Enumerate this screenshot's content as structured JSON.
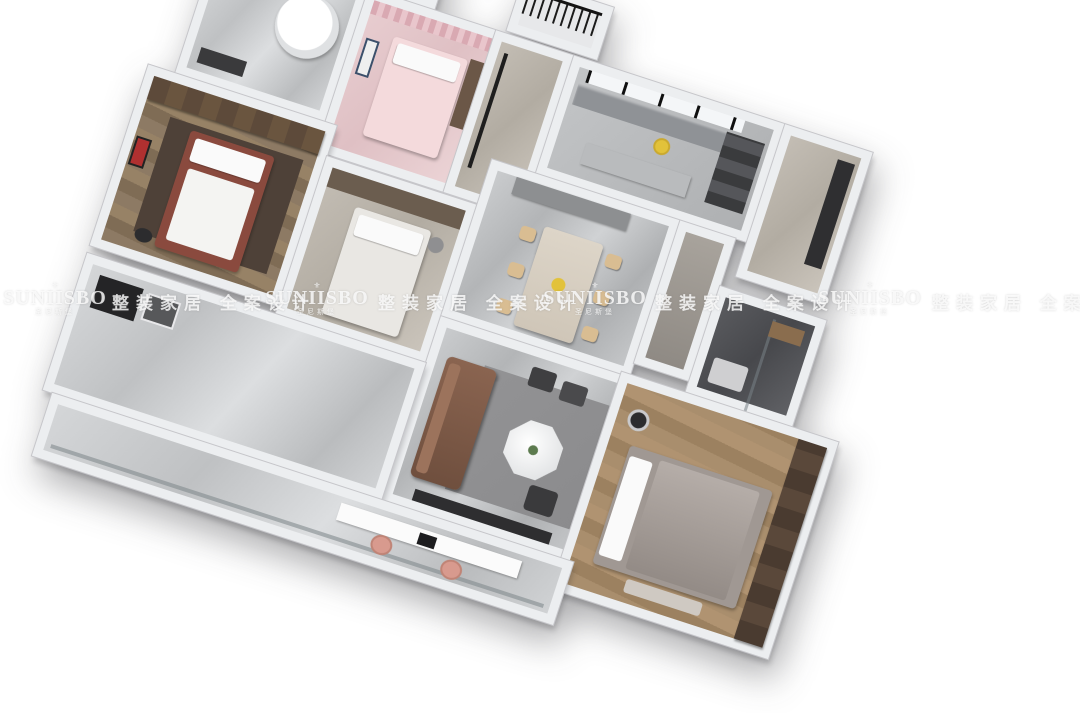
{
  "scene": {
    "kind": "3d-isometric-floorplan-render",
    "background_color": "#ffffff",
    "palette": {
      "wall": "#eceef0",
      "marble_floor": "#bfc1c3",
      "wood_floor": "#a98e6d",
      "kids_pink": "#e4c8cc",
      "dark_tile": "#4f5054",
      "sofa_brown": "#7d5a49",
      "chair_tan": "#d9bd92",
      "railing_black": "#1b1b1b",
      "accent_flower_yellow": "#e2c23a"
    },
    "rooms": [
      "top-balcony-left",
      "top-balcony-right",
      "bathroom-with-tub",
      "kids-bedroom",
      "top-hallway",
      "kitchen",
      "foyer",
      "left-bedroom",
      "middle-bedroom",
      "dining-room",
      "right-corridor",
      "master-bathroom",
      "living-room",
      "master-bedroom",
      "utility-area",
      "bottom-balcony"
    ]
  },
  "watermark": {
    "slogan": "整装家居 全案设计",
    "logo": {
      "ornament": "⚜",
      "name": "SUNIISBO",
      "subtext": "圣尼斯堡"
    }
  }
}
